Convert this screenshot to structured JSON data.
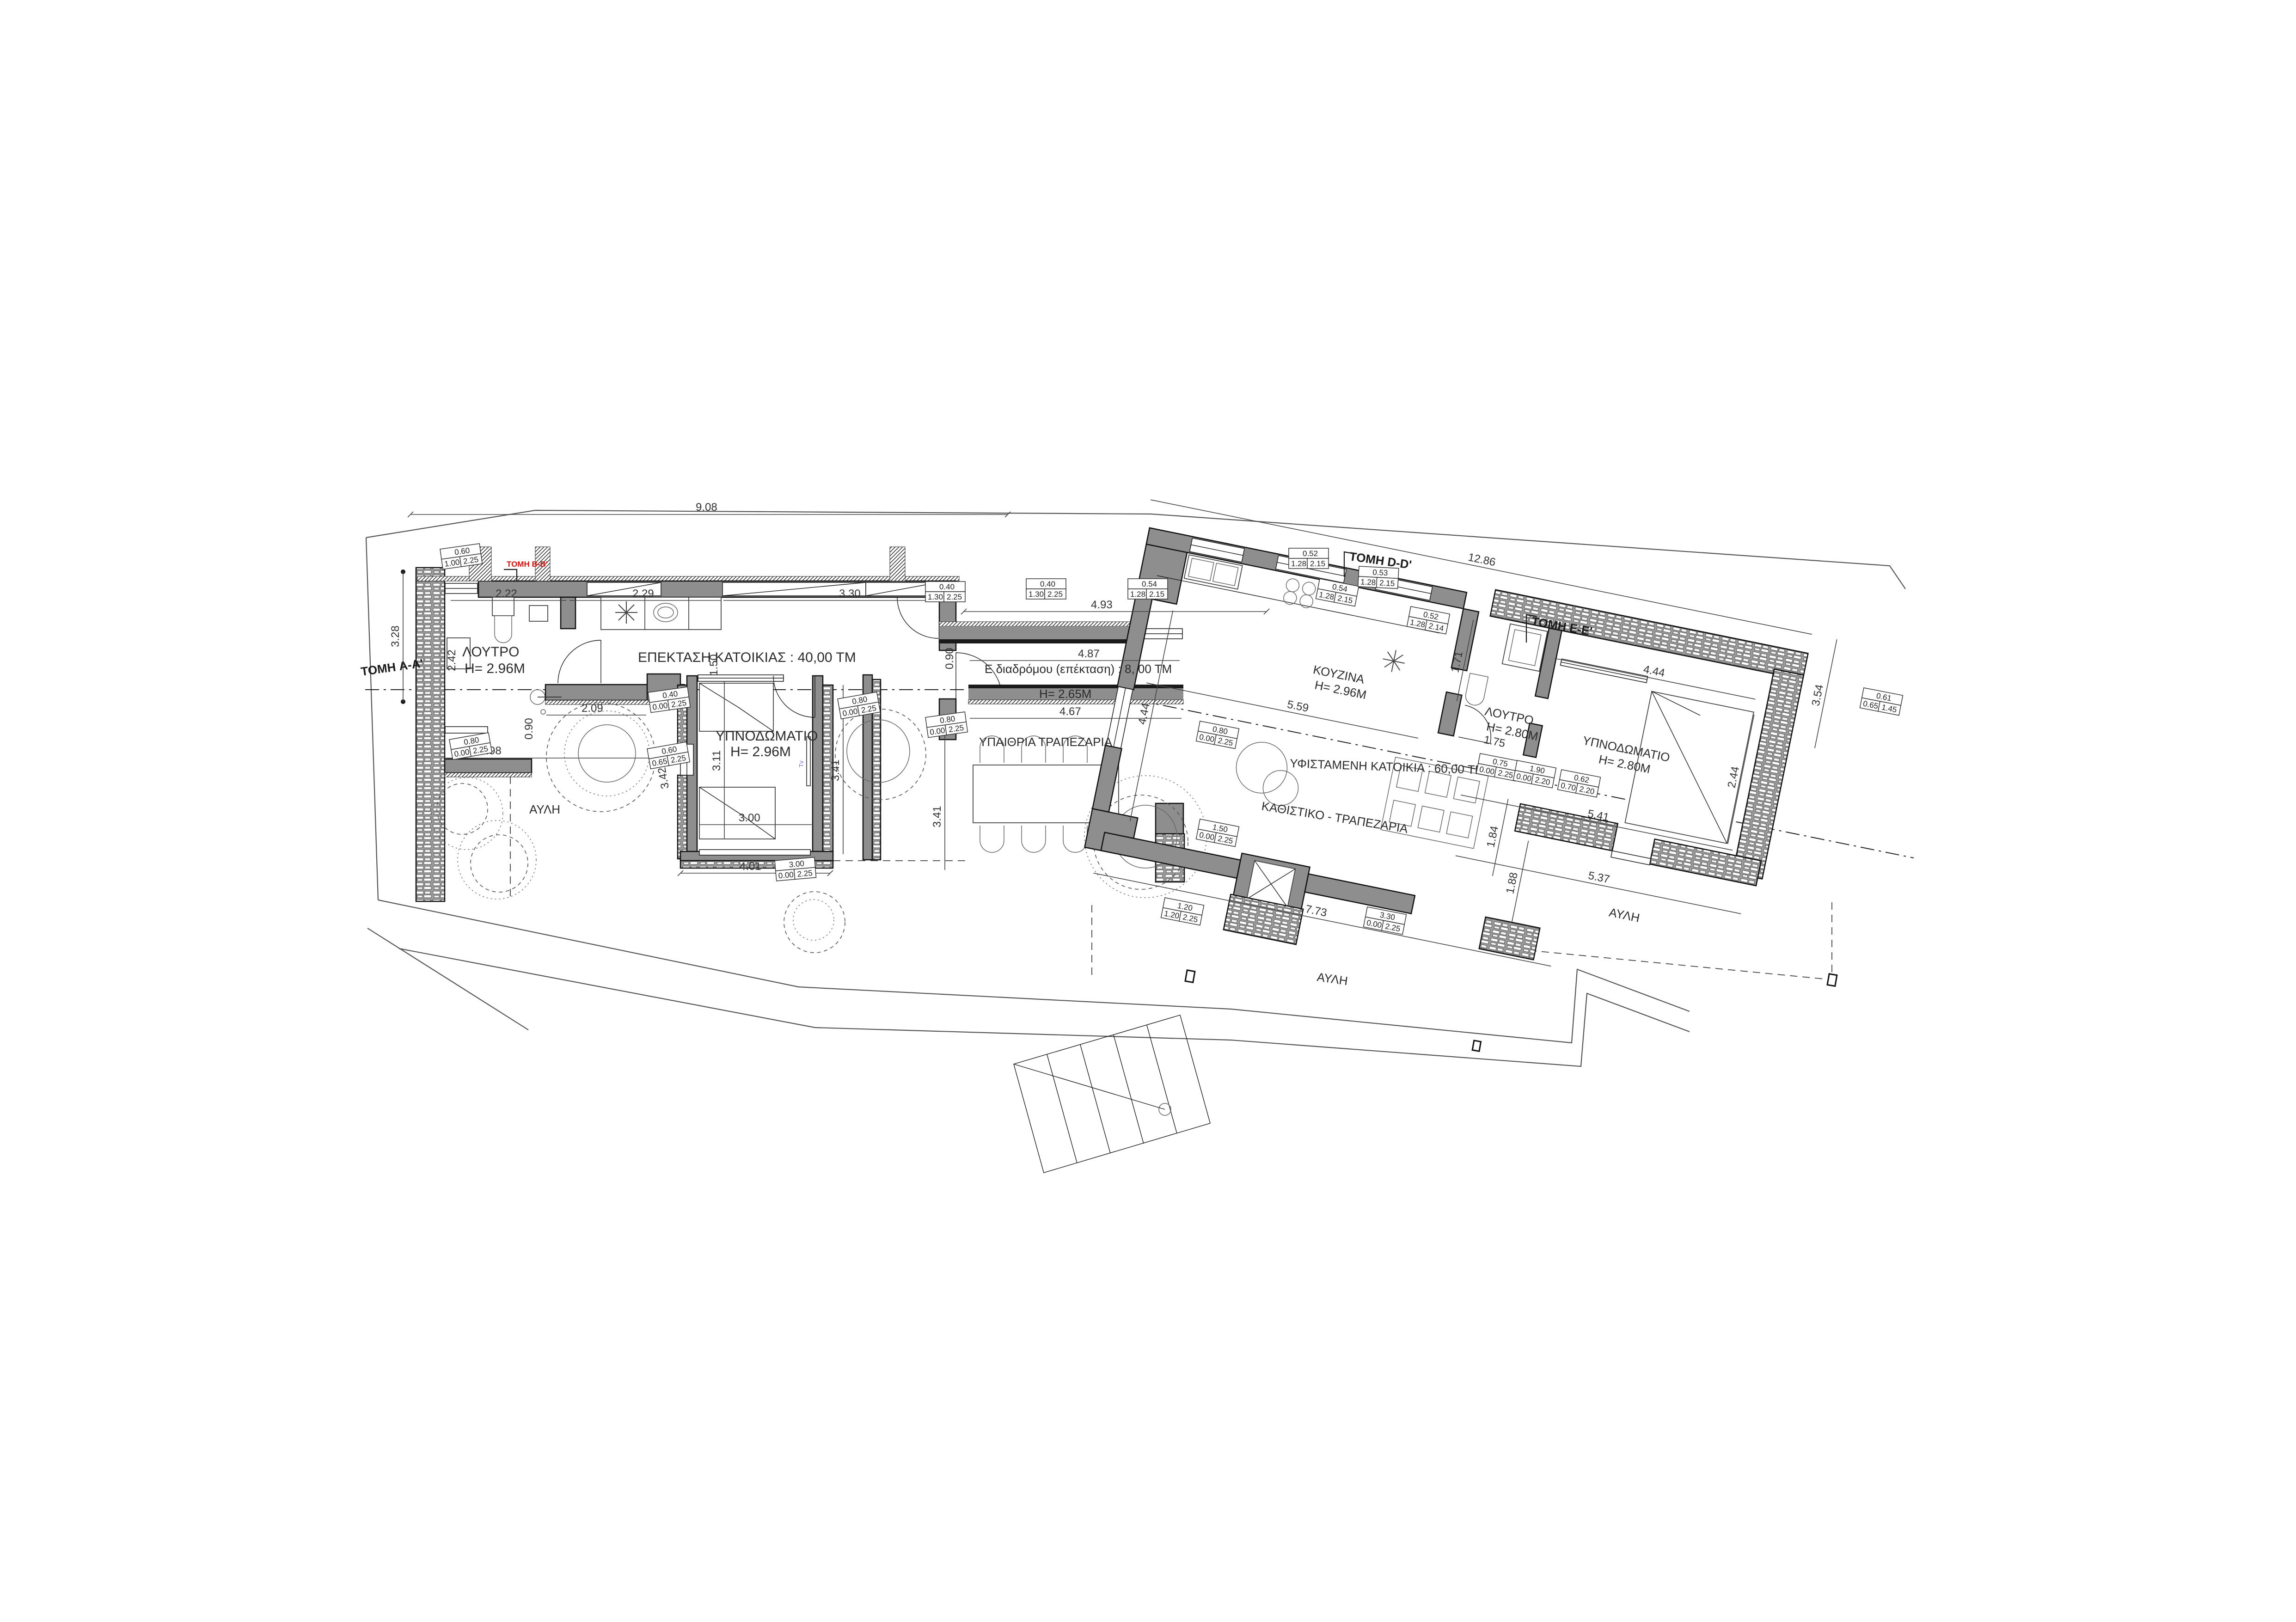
{
  "accent_colors": {
    "wall_gray": "#8e8e8e",
    "section_red": "#cc1111",
    "tv_blue": "#7777cc"
  },
  "rooms": {
    "loutro_left": {
      "name": "ΛΟΥΤΡΟ",
      "height": "Η= 2.96Μ"
    },
    "extension": {
      "name": "ΕΠΕΚΤΑΣΗ ΚΑΤΟΙΚΙΑΣ : 40,00 ΤΜ"
    },
    "bedroom_left": {
      "name": "ΥΠΝΟΔΩΜΑΤΙΟ",
      "height": "Η= 2.96Μ"
    },
    "corridor": {
      "name": "Ε διαδρόμου (επέκταση) : 8, 00 ΤΜ",
      "height": "Η= 2.65Μ"
    },
    "outdoor_dining": {
      "name": "ΥΠΑΙΘΡΙΑ ΤΡΑΠΕΖΑΡΙΑ"
    },
    "kitchen": {
      "name": "ΚΟΥΖΙΝΑ",
      "height": "Η= 2.96Μ"
    },
    "existing_house": {
      "name": "ΥΦΙΣΤΑΜΕΝΗ  ΚΑΤΟΙΚΙΑ : 60,00 ΤΜ"
    },
    "living": {
      "name": "ΚΑΘΙΣΤΙΚΟ - ΤΡΑΠΕΖΑΡΙΑ"
    },
    "loutro_right": {
      "name": "ΛΟΥΤΡΟ",
      "height": "Η= 2.80Μ"
    },
    "bedroom_right": {
      "name": "ΥΠΝΟΔΩΜΑΤΙΟ",
      "height": "Η= 2.80Μ"
    },
    "court_left": {
      "name": "ΑΥΛΗ"
    },
    "court_bottom": {
      "name": "ΑΥΛΗ"
    },
    "court_right": {
      "name": "ΑΥΛΗ"
    },
    "tv": "Tv"
  },
  "sections": {
    "aa": "ΤΟΜΗ A-A'",
    "bb": "ΤΟΜΗ Β-Β'",
    "dd": "ΤΟΜΗ D-D'",
    "ee": "ΤΟΜΗ Ε-Ε'"
  },
  "dims": {
    "top": "9.08",
    "left_h": "3.28",
    "bath_w": "2.22",
    "kitchen_w": "2.29",
    "wardrobe_w": "3.30",
    "bath_d": "2.42",
    "hall": "1.50",
    "court_door": "0.90",
    "bath_low": "2.09",
    "court_w": "2.98",
    "bed_l_h": "3.11",
    "bed_l_w": "3.00",
    "bed_l_total": "4.01",
    "side_a": "3.41",
    "side_b": "3.41",
    "side_c": "3.42",
    "corr_top": "4.93",
    "corr_in": "4.87",
    "corr_low": "4.67",
    "corr_door": "0.90",
    "kit_len": "5.59",
    "liv_side": "4.44",
    "total_right": "12.86",
    "bed_r_w": "4.44",
    "bed_r_low": "5.41",
    "bed_r_h": "2.44",
    "right_side": "3.54",
    "gap_a": "1.84",
    "gap_b": "1.88",
    "bath_r_w": "1.71",
    "bath_r_d": "1.75",
    "liv_w": "7.73",
    "court_r": "5.37"
  },
  "tags": [
    {
      "w": "0.60",
      "s": "1.00",
      "h": "2.25"
    },
    {
      "w": "0.40",
      "s": "1.30",
      "h": "2.25"
    },
    {
      "w": "0.40",
      "s": "1.30",
      "h": "2.25"
    },
    {
      "w": "0.54",
      "s": "1.28",
      "h": "2.15"
    },
    {
      "w": "0.54",
      "s": "1.28",
      "h": "2.15"
    },
    {
      "w": "0.52",
      "s": "1.28",
      "h": "2.15"
    },
    {
      "w": "0.53",
      "s": "1.28",
      "h": "2.15"
    },
    {
      "w": "0.52",
      "s": "1.28",
      "h": "2.14"
    },
    {
      "w": "0.80",
      "s": "0.00",
      "h": "2.25"
    },
    {
      "w": "0.40",
      "s": "0.00",
      "h": "2.25"
    },
    {
      "w": "0.60",
      "s": "0.65",
      "h": "2.25"
    },
    {
      "w": "0.80",
      "s": "0.00",
      "h": "2.25"
    },
    {
      "w": "3.00",
      "s": "0.00",
      "h": "2.25"
    },
    {
      "w": "0.80",
      "s": "0.00",
      "h": "2.25"
    },
    {
      "w": "0.80",
      "s": "0.00",
      "h": "2.25"
    },
    {
      "w": "1.50",
      "s": "0.00",
      "h": "2.25"
    },
    {
      "w": "1.20",
      "s": "1.20",
      "h": "2.25"
    },
    {
      "w": "3.30",
      "s": "0.00",
      "h": "2.25"
    },
    {
      "w": "0.75",
      "s": "0.00",
      "h": "2.25"
    },
    {
      "w": "1.90",
      "s": "0.00",
      "h": "2.20"
    },
    {
      "w": "0.62",
      "s": "0.70",
      "h": "2.20"
    },
    {
      "w": "0.61",
      "s": "0.65",
      "h": "1.45"
    }
  ]
}
